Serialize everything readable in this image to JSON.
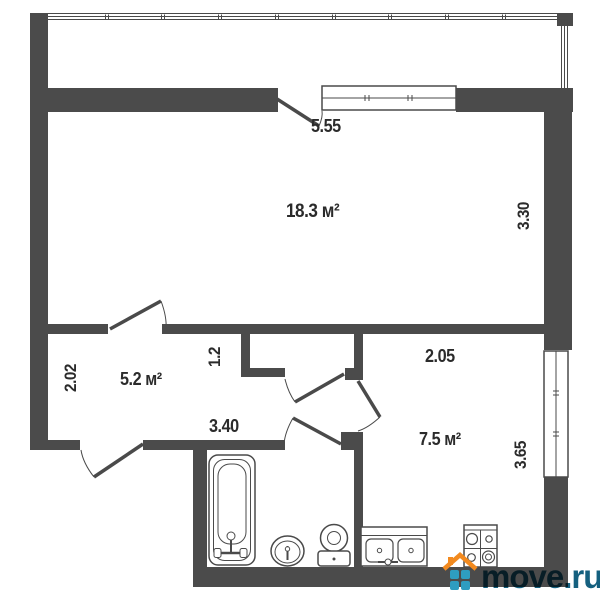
{
  "rooms": {
    "living": {
      "area_label": "18.3 м²"
    },
    "hallway": {
      "area_label": "5.2 м²"
    },
    "kitchen": {
      "area_label": "7.5 м²"
    }
  },
  "dimensions": {
    "balcony_wall_width": "5.55",
    "living_depth": "3.30",
    "hallway_depth": "2.02",
    "corridor_width": "1.2",
    "hallway_width": "3.40",
    "kitchen_width": "2.05",
    "kitchen_depth": "3.65"
  },
  "watermark": {
    "text": "move.ru"
  },
  "fixtures": [
    "bathtub",
    "wash-basin",
    "toilet",
    "kitchen-sink",
    "stove"
  ],
  "colors": {
    "wall": "#4b4b4b",
    "line": "#4a4a4a",
    "label_text": "#2b2b2b",
    "watermark_text": "#15607f",
    "brand_orange": "#f28a1f",
    "brand_blue": "#2e9dc0"
  }
}
